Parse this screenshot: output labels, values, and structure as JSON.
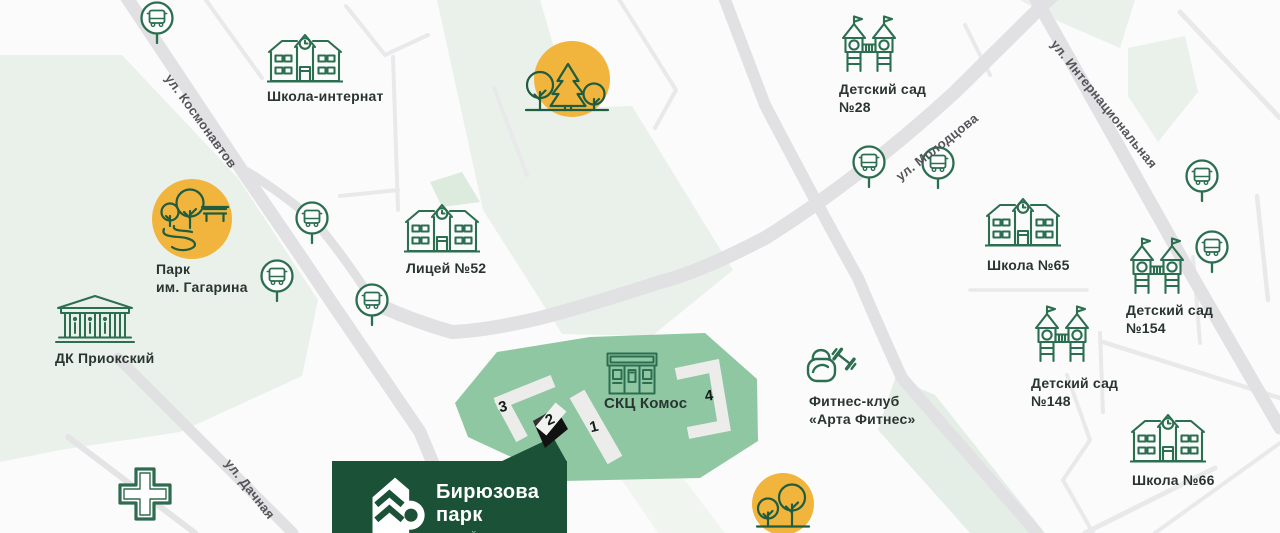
{
  "colors": {
    "icon_green": "#2C6E50",
    "area_green": "#8FC7A2",
    "light_green": "#E9F1EA",
    "accent_yellow": "#F1B53D",
    "brand_green": "#1B5137",
    "road_gray": "#E1E1E3",
    "text_dark": "#2A3531",
    "street_text": "#54555A"
  },
  "streets": {
    "kosmonavtov": {
      "label": "ул. Космонавтов"
    },
    "molodtsova": {
      "label": "ул. Молодцова"
    },
    "internatsionalnaya": {
      "label": "ул. Интернациональная"
    },
    "dachnaya": {
      "label": "ул. Дачная"
    }
  },
  "places": {
    "boarding_school": {
      "label": "Школа-интернат"
    },
    "kindergarten_28": {
      "line1": "Детский сад",
      "line2": "№28"
    },
    "park_gagarina": {
      "line1": "Парк",
      "line2": "им. Гагарина"
    },
    "lyceum_52": {
      "label": "Лицей №52"
    },
    "dk_prioksky": {
      "label": "ДК Приокский"
    },
    "school_65": {
      "label": "Школа №65"
    },
    "kindergarten_154": {
      "line1": "Детский сад",
      "line2": "№154"
    },
    "kindergarten_148": {
      "line1": "Детский сад",
      "line2": "№148"
    },
    "school_66": {
      "label": "Школа №66"
    },
    "skc_komos": {
      "label": "СКЦ Комос"
    },
    "fitness_club": {
      "line1": "Фитнес-клуб",
      "line2": "«Арта Фитнес»"
    }
  },
  "residential": {
    "building_1": "1",
    "building_2": "2",
    "building_3": "3",
    "building_4": "4"
  },
  "logo": {
    "line1": "Бирюзова",
    "line2": "парк",
    "subtitle": "жилой комплекс"
  }
}
